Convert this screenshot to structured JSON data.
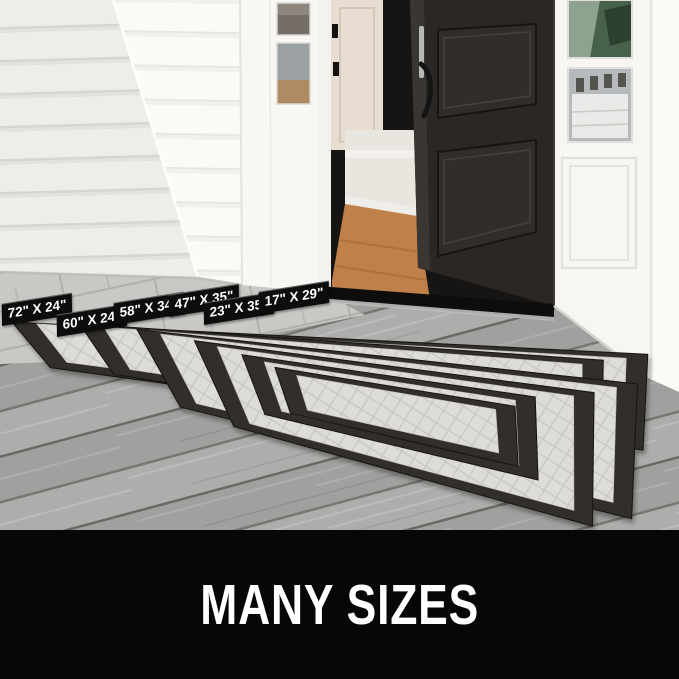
{
  "banner": {
    "text": "MANY SIZES"
  },
  "scene": {
    "description": "porch product photo of nested doormats",
    "mats": [
      {
        "label": "72\" X 24\"",
        "width_in": 72,
        "depth_in": 24
      },
      {
        "label": "60\" X 24\"",
        "width_in": 60,
        "depth_in": 24
      },
      {
        "label": "58\" X 34\"",
        "width_in": 58,
        "depth_in": 34
      },
      {
        "label": "47\" X 35\"",
        "width_in": 47,
        "depth_in": 35
      },
      {
        "label": "23\" X 35\"",
        "width_in": 35,
        "depth_in": 23
      },
      {
        "label": "17\" X 29\"",
        "width_in": 29,
        "depth_in": 17
      }
    ],
    "colors": {
      "mat_border": "#332f2b",
      "mat_center": "#dedcd6",
      "mat_quilt_line": "#cac8c2",
      "banner_bg": "#070707",
      "banner_text": "#ffffff",
      "label_bg": "#0d0d0d",
      "label_text": "#ffffff",
      "deck_plank": "#a9a9a7",
      "deck_gap": "#6f6f6c",
      "pavers": "#c9c8c4",
      "siding_white": "#f6f5f2",
      "door_black": "#2a2724",
      "interior_floor": "#c08049"
    }
  }
}
